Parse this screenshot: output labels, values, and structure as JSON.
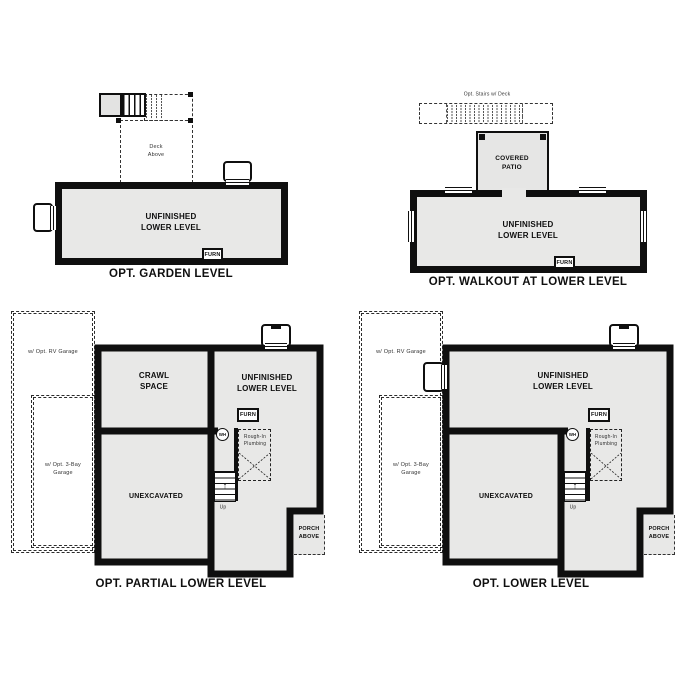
{
  "sheet_name": "Lower Level Options Floor Plans",
  "colors": {
    "background": "#ffffff",
    "wall": "#0f0f0f",
    "room_fill": "#e8e8e7",
    "dashed_line": "#333333"
  },
  "icons": {
    "up_arrow": "↑"
  },
  "plans": {
    "garden_level": {
      "title": "OPT. GARDEN LEVEL",
      "main_room_label": "UNFINISHED\nLOWER LEVEL",
      "deck_label": "Deck\nAbove",
      "furnace_label": "FURN"
    },
    "walkout": {
      "title": "OPT. WALKOUT AT LOWER LEVEL",
      "main_room_label": "UNFINISHED\nLOWER LEVEL",
      "patio_label": "COVERED\nPATIO",
      "opt_stairs_label": "Opt. Stairs w/ Deck",
      "furnace_label": "FURN"
    },
    "partial_lower_level": {
      "title": "OPT. PARTIAL LOWER LEVEL",
      "crawl_space_label": "CRAWL\nSPACE",
      "main_room_label": "UNFINISHED\nLOWER LEVEL",
      "unexcavated_label": "UNEXCAVATED",
      "rv_garage_label": "w/ Opt. RV Garage",
      "three_bay_garage_label": "w/ Opt. 3-Bay\nGarage",
      "porch_label": "PORCH\nABOVE",
      "furnace_label": "FURN",
      "water_heater_label": "WH",
      "plumbing_label": "Rough-In\nPlumbing",
      "up_label": "Up"
    },
    "lower_level": {
      "title": "OPT. LOWER LEVEL",
      "main_room_label": "UNFINISHED\nLOWER LEVEL",
      "unexcavated_label": "UNEXCAVATED",
      "rv_garage_label": "w/ Opt. RV Garage",
      "three_bay_garage_label": "w/ Opt. 3-Bay\nGarage",
      "porch_label": "PORCH\nABOVE",
      "furnace_label": "FURN",
      "water_heater_label": "WH",
      "plumbing_label": "Rough-In\nPlumbing",
      "up_label": "Up"
    }
  }
}
